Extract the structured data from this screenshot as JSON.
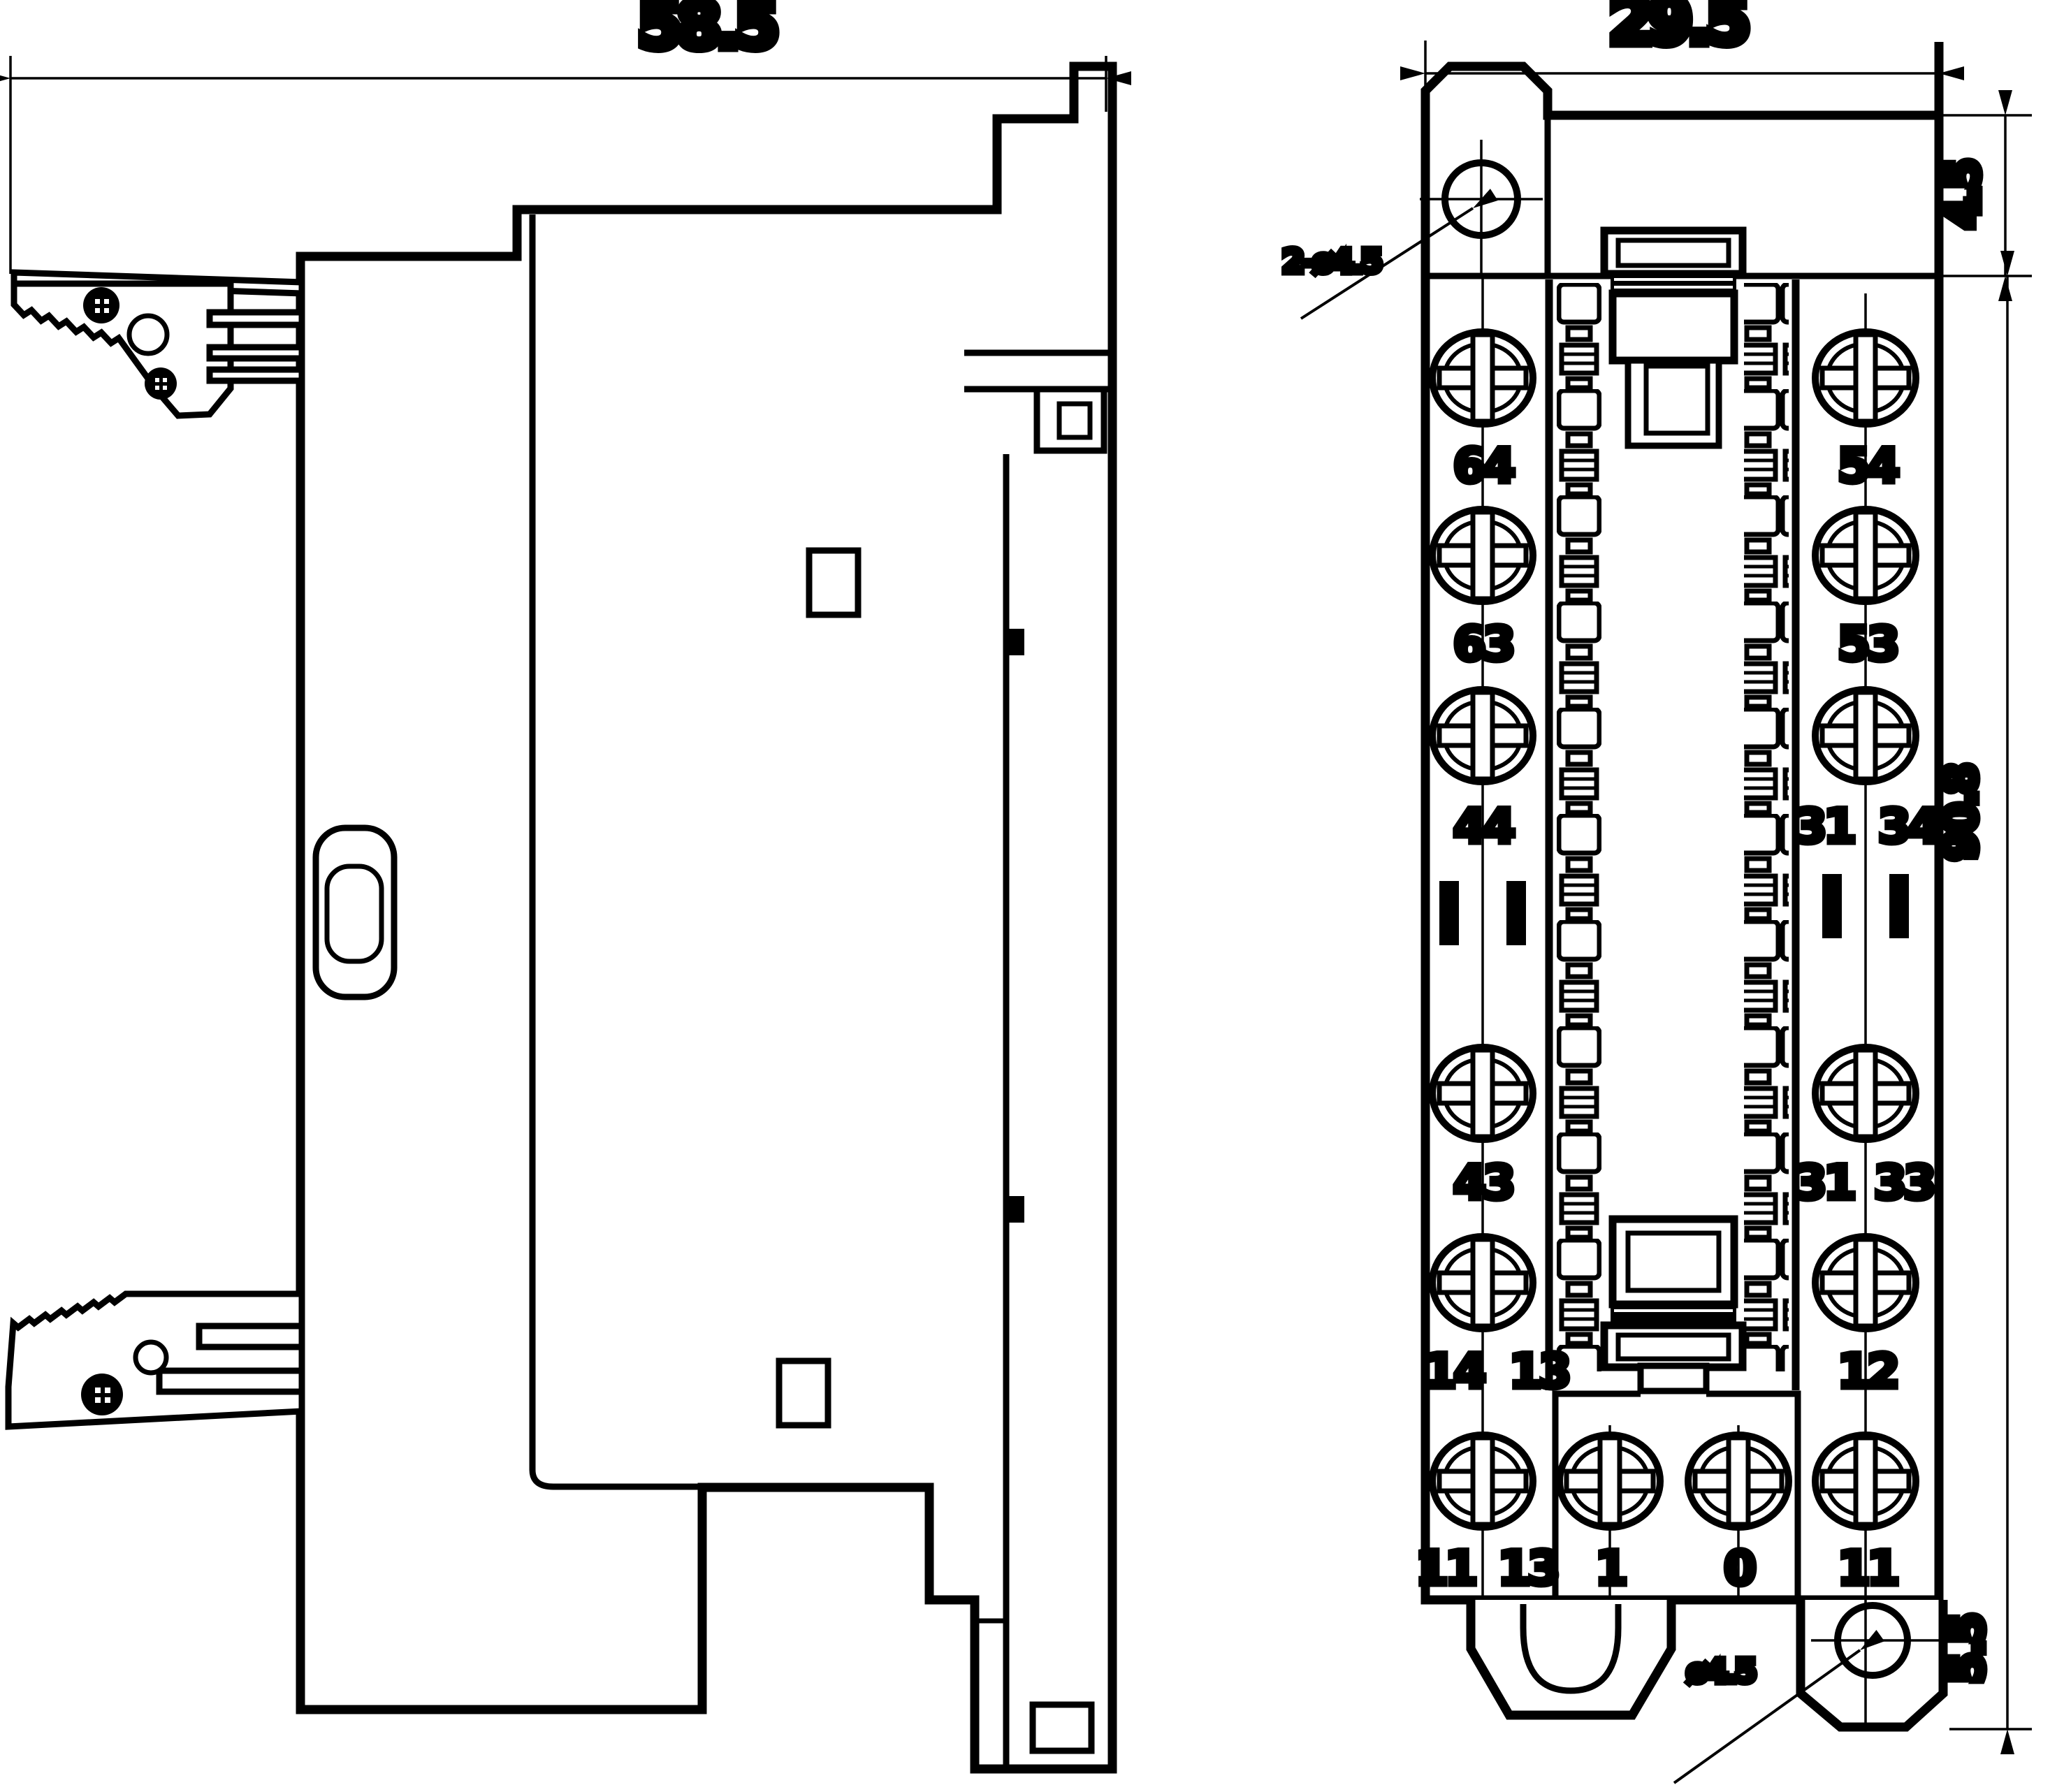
{
  "dimensions": {
    "side_overall_width": "58.5",
    "front_overall_width": "29.5",
    "hole_center_from_top": "4.5",
    "front_overall_height": "90.8",
    "bottom_tab_height": "5.5",
    "top_hole_callout": "2-ø4.5",
    "bottom_hole_callout": "ø4.5"
  },
  "terminals": {
    "l1": "64",
    "l2": "63",
    "l3": "44",
    "l4": "43",
    "l5a": "14",
    "l5b": "13",
    "b1a": "11",
    "b1b": "13",
    "b2": "1",
    "b3": "0",
    "b4": "11",
    "r1": "54",
    "r2": "53",
    "r3a": "31",
    "r3b": "34",
    "r4a": "31",
    "r4b": "33",
    "r5": "12"
  }
}
